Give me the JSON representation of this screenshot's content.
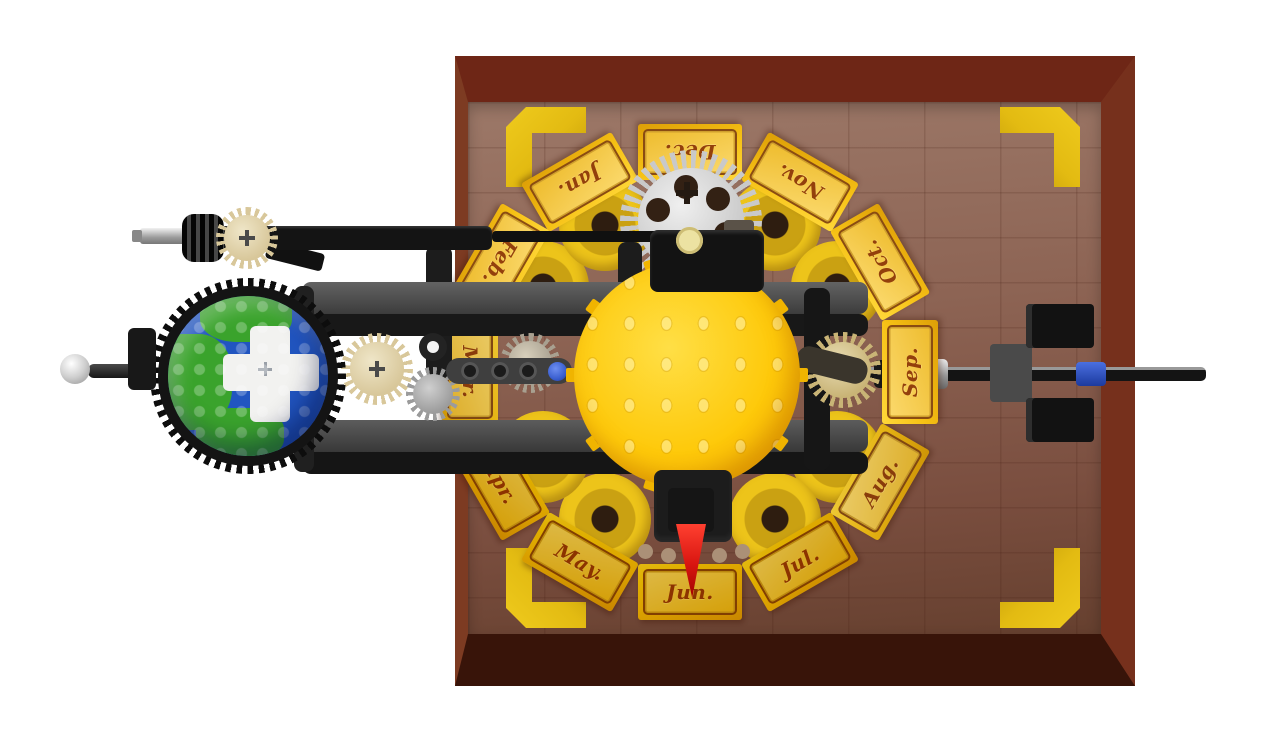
{
  "scene": {
    "months": [
      {
        "label": "Jan."
      },
      {
        "label": "Feb."
      },
      {
        "label": "Mar."
      },
      {
        "label": "Apr."
      },
      {
        "label": "May."
      },
      {
        "label": "Jun."
      },
      {
        "label": "Jul."
      },
      {
        "label": "Aug."
      },
      {
        "label": "Sep."
      },
      {
        "label": "Oct."
      },
      {
        "label": "Nov."
      },
      {
        "label": "Dec."
      }
    ],
    "pointer_target": "Jun.",
    "colors": {
      "board": "#8d6454",
      "frame": "#6e2616",
      "accent_gold": "#e3bb12",
      "tile_gold": "#f6c115",
      "tile_text": "#93400c",
      "sun_yellow": "#fec90a",
      "earth_blue": "#2155c0",
      "earth_green": "#3aa32c",
      "pointer_red": "#d81510",
      "silver": "#c9c9c9",
      "tan_gear": "#d8c79a",
      "axle_blue": "#3a5fd0"
    }
  }
}
